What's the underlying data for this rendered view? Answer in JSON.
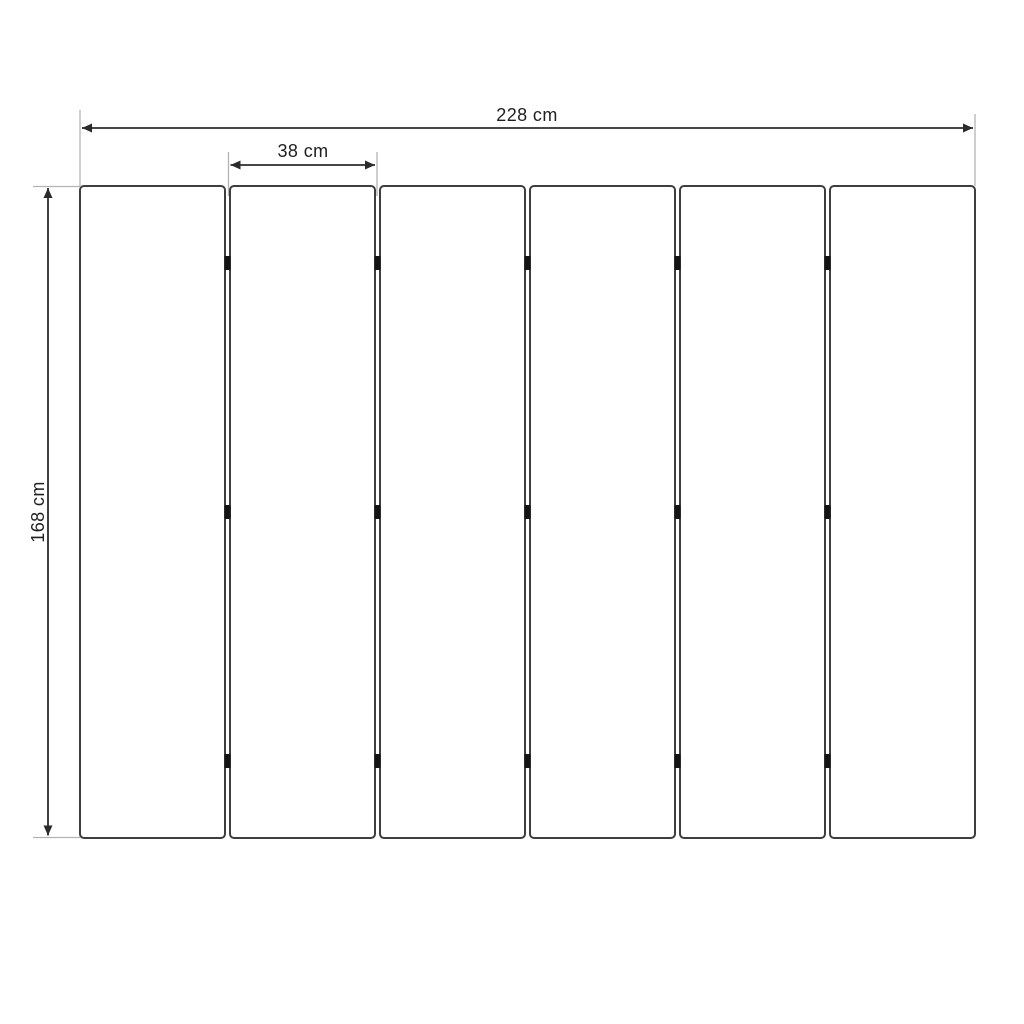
{
  "diagram": {
    "type": "technical dimension drawing",
    "dimensions": {
      "total_width": {
        "label": "228 cm",
        "value": 228,
        "unit": "cm"
      },
      "panel_width": {
        "label": "38 cm",
        "value": 38,
        "unit": "cm"
      },
      "height": {
        "label": "168 cm",
        "value": 168,
        "unit": "cm"
      }
    },
    "panels": {
      "count": 6,
      "gap_count": 5,
      "hinge_rows_per_gap": 3
    },
    "colors": {
      "background": "#ffffff",
      "panel_fill": "#ffffff",
      "panel_stroke": "#3e3e3e",
      "dimension_line": "#2b2b2b",
      "extension_line": "#b3b3b3",
      "hinge": "#141414",
      "text": "#1f1f1f"
    }
  }
}
